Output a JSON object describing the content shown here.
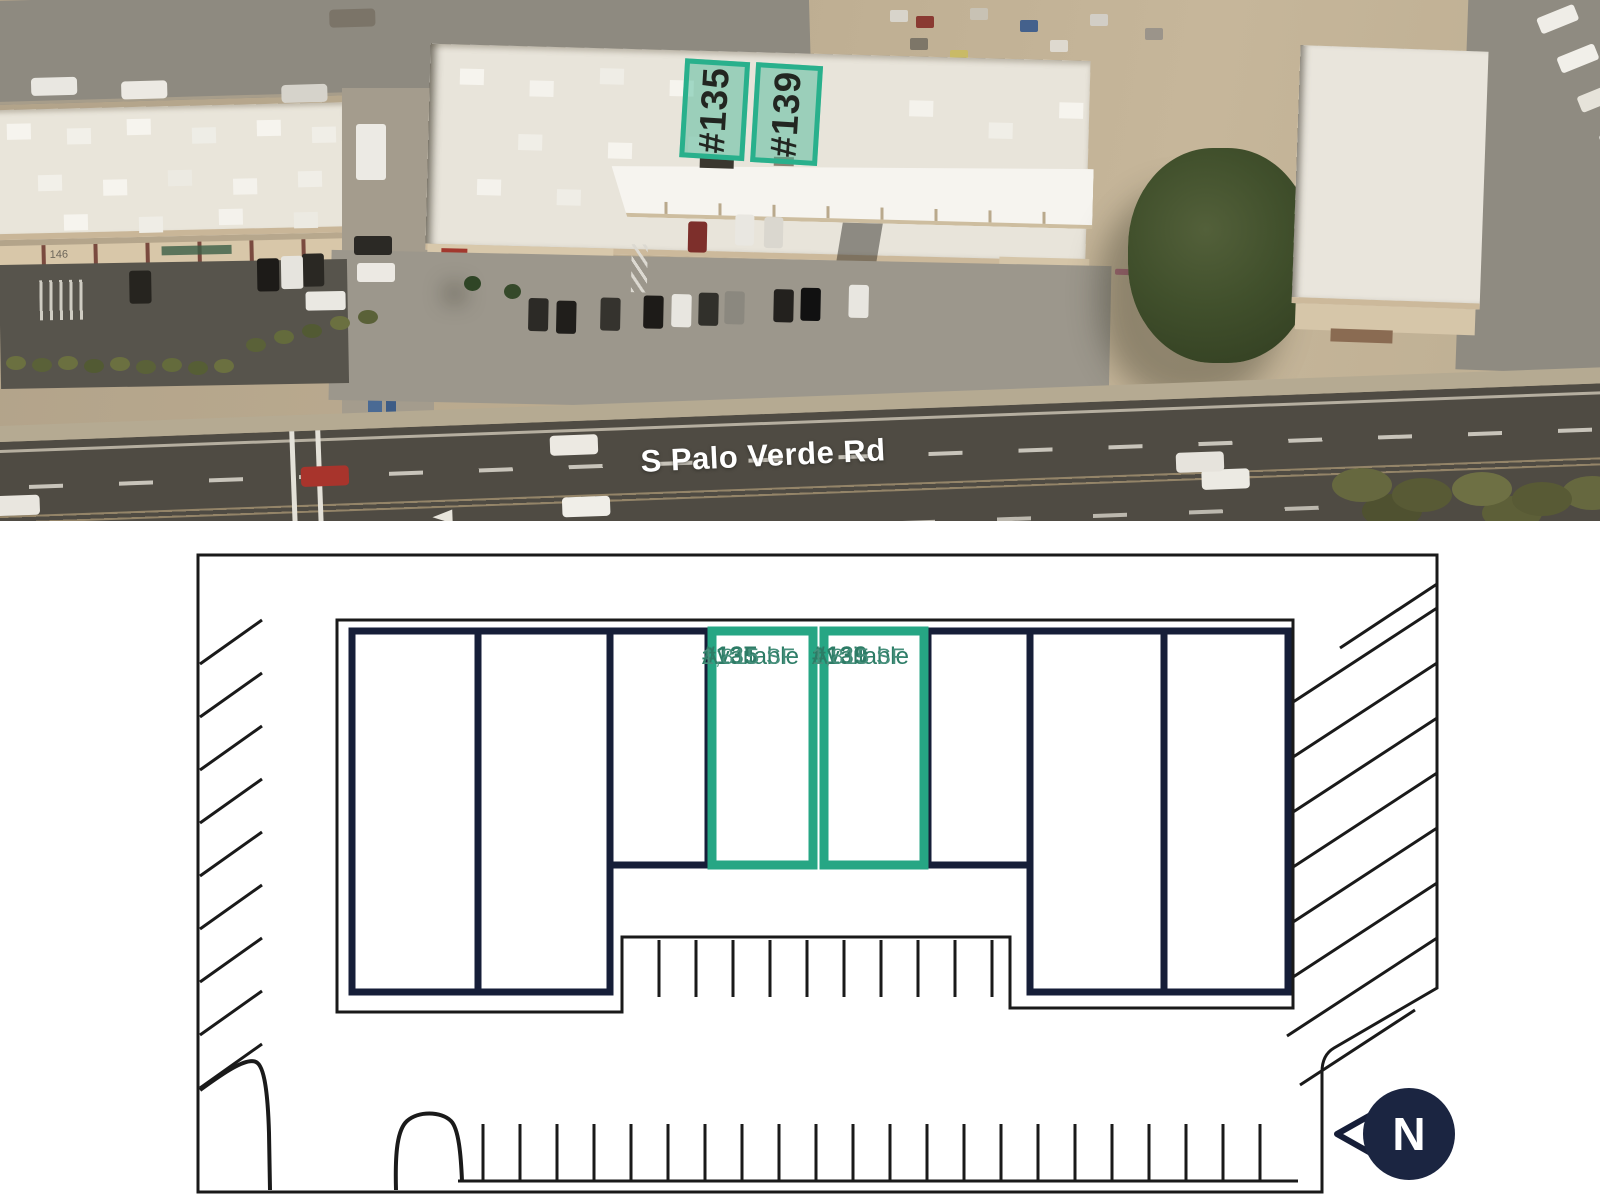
{
  "colors": {
    "accent_green": "#26a684",
    "aerial_green_fill": "rgba(62,182,146,0.45)",
    "navy_wall": "#161e38",
    "compass_navy": "#1b2541",
    "plan_line": "#1a1a1a",
    "plan_text_green": "#2d7c66"
  },
  "aerial": {
    "units": [
      {
        "id": "#135"
      },
      {
        "id": "#139"
      }
    ],
    "road_label": "S Palo Verde Rd",
    "left_building_address": "146"
  },
  "plan": {
    "units": [
      {
        "number": "#135",
        "status": "Available",
        "area": "1,815 SF"
      },
      {
        "number": "#139",
        "status": "Available",
        "area": "1,815 SF"
      }
    ],
    "compass_label": "N"
  }
}
